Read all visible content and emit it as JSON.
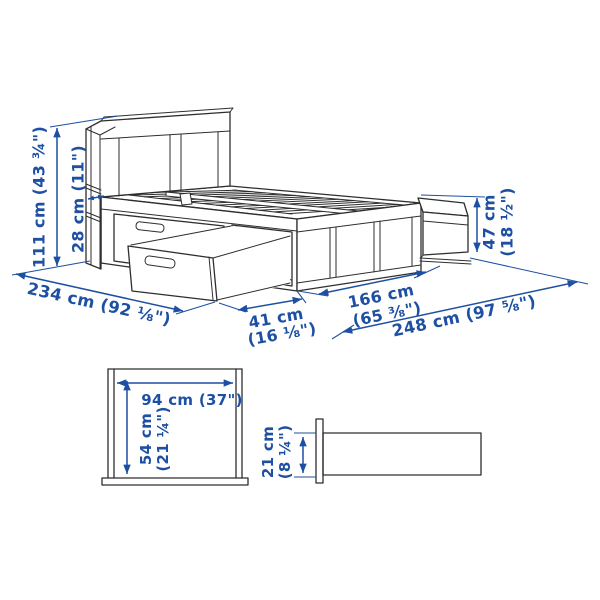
{
  "colors": {
    "dimension_blue": "#1d4fa3",
    "drawing_ink": "#2e2e2e",
    "background": "#ffffff"
  },
  "main_view": {
    "description": "bed-with-storage-isometric-line-drawing",
    "labels": {
      "total_height": "111 cm (43 ¾\")",
      "headboard_depth": "28 cm (11\")",
      "total_length": "234 cm (92 ⅛\")",
      "drawer_pullout_l1": "41 cm",
      "drawer_pullout_l2": "(16 ⅛\")",
      "frame_length_l1": "166 cm",
      "frame_length_l2": "(65 ⅜\")",
      "length_with_drawers": "248 cm (97 ⅝\")",
      "side_height_l1": "47 cm",
      "side_height_l2": "(18 ½\")"
    }
  },
  "drawer_front_view": {
    "description": "drawer-front-elevation-drawing",
    "labels": {
      "width": "94 cm (37\")",
      "height_l1": "54 cm",
      "height_l2": "(21 ¼\")"
    }
  },
  "side_profile_view": {
    "description": "side-rail-profile-drawing",
    "labels": {
      "height_l1": "21 cm",
      "height_l2": "(8 ¼\")"
    }
  }
}
